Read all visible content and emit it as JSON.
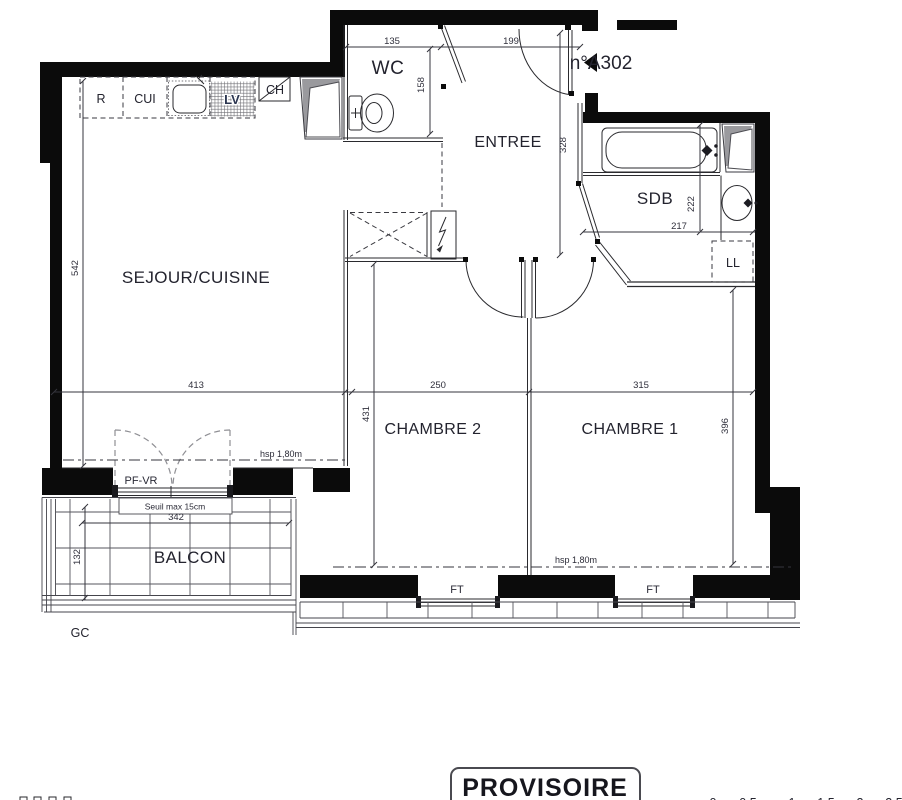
{
  "unit": {
    "label": "n°A302"
  },
  "rooms": {
    "wc": "WC",
    "entree": "ENTREE",
    "sdb": "SDB",
    "ll": "LL",
    "sejour": "SEJOUR/CUISINE",
    "chambre2": "CHAMBRE 2",
    "chambre1": "CHAMBRE 1",
    "balcon": "BALCON"
  },
  "kitchen": {
    "fridge": "R",
    "hob": "CUI",
    "dishwasher": "LV",
    "boiler": "CH"
  },
  "dims": {
    "d135": "135",
    "d199": "199",
    "d158": "158",
    "d328": "328",
    "d222": "222",
    "d217": "217",
    "d542": "542",
    "d413": "413",
    "d250": "250",
    "d315": "315",
    "d431": "431",
    "d396": "396",
    "d342": "342",
    "d132": "132"
  },
  "ann": {
    "pfvr": "PF-VR",
    "seuil": "Seuil max 15cm",
    "hsp_sejour": "hsp 1,80m",
    "hsp_chambres": "hsp 1,80m",
    "ft1": "FT",
    "ft2": "FT",
    "gc": "GC"
  },
  "stamp": "PROVISOIRE",
  "scale_marks": [
    "0",
    "0,5",
    "1",
    "1,5",
    "2",
    "2,5"
  ],
  "colors": {
    "wall": "#0b0b0b",
    "line": "#2a2a2e",
    "gray_leaf": "#9a9a9e"
  }
}
